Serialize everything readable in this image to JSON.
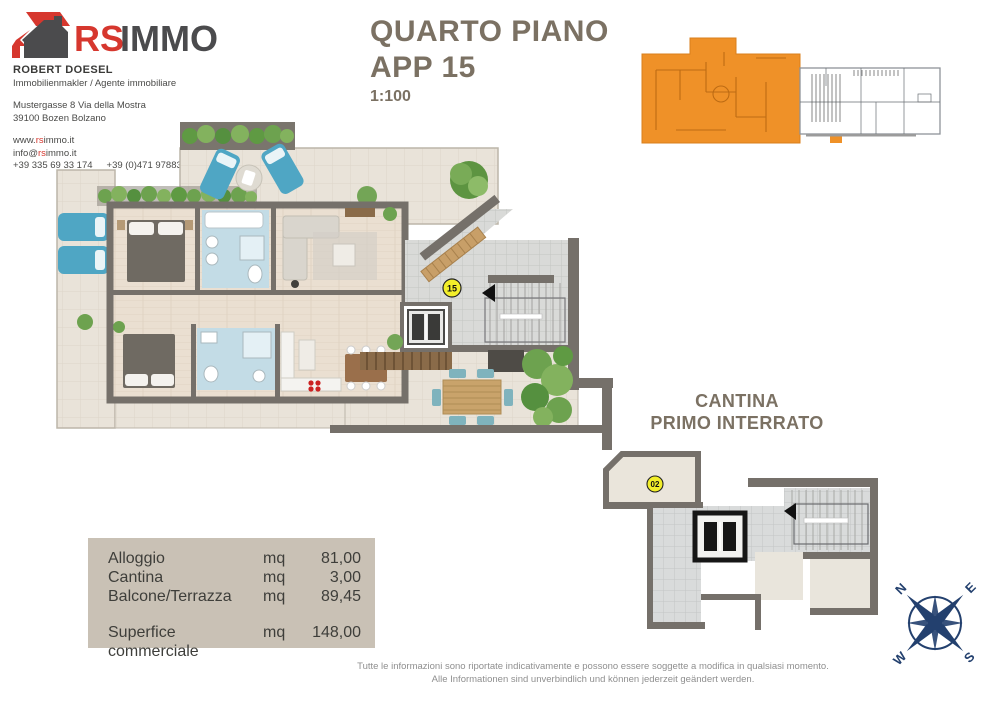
{
  "logo": {
    "rs": "RS",
    "immo": "IMMO"
  },
  "agent": {
    "name": "ROBERT DOESEL",
    "role": "Immobilienmakler / Agente immobiliare",
    "address_line1": "Mustergasse 8 Via della Mostra",
    "address_line2": "39100 Bozen Bolzano",
    "website": {
      "pre": "www.",
      "accent": "rs",
      "post": "immo.it"
    },
    "email": {
      "pre": "info@",
      "accent": "rs",
      "post": "immo.it"
    },
    "phone1": "+39 335 69 33 174",
    "phone2": "+39 (0)471 978830"
  },
  "title": {
    "line1": "QUARTO PIANO",
    "line2": "APP 15",
    "scale": "1:100"
  },
  "main_plan": {
    "unit_badge": "15"
  },
  "cantina": {
    "heading_line1": "CANTINA",
    "heading_line2": "PRIMO INTERRATO",
    "unit_badge": "02"
  },
  "area_table": {
    "rows": [
      {
        "label": "Alloggio",
        "unit": "mq",
        "value": "81,00"
      },
      {
        "label": "Cantina",
        "unit": "mq",
        "value": "3,00"
      },
      {
        "label": "Balcone/Terrazza",
        "unit": "mq",
        "value": "89,45"
      }
    ],
    "total": {
      "label": "Superfice commerciale",
      "unit": "mq",
      "value": "148,00"
    }
  },
  "compass": {
    "north": "N",
    "east": "E",
    "south": "S",
    "west": "W"
  },
  "footer": {
    "line1": "Tutte le informazioni sono riportate indicativamente e possono essere soggette a modifica in qualsiasi momento.",
    "line2": "Alle Informationen sind unverbindlich und können jederzeit geändert werden."
  },
  "colors": {
    "logo_red": "#d6372e",
    "logo_gray": "#4b4b4d",
    "title_brown": "#7b7163",
    "highlight_orange": "#ef9128",
    "badge_yellow": "#f2ee2a",
    "table_background": "#c9c1b5",
    "compass_navy": "#23406e",
    "wall_gray": "#75706a",
    "terrace_beige": "#e9e3d9",
    "bath_blue": "#c3dce6",
    "lounger_teal": "#4fa6c4"
  }
}
